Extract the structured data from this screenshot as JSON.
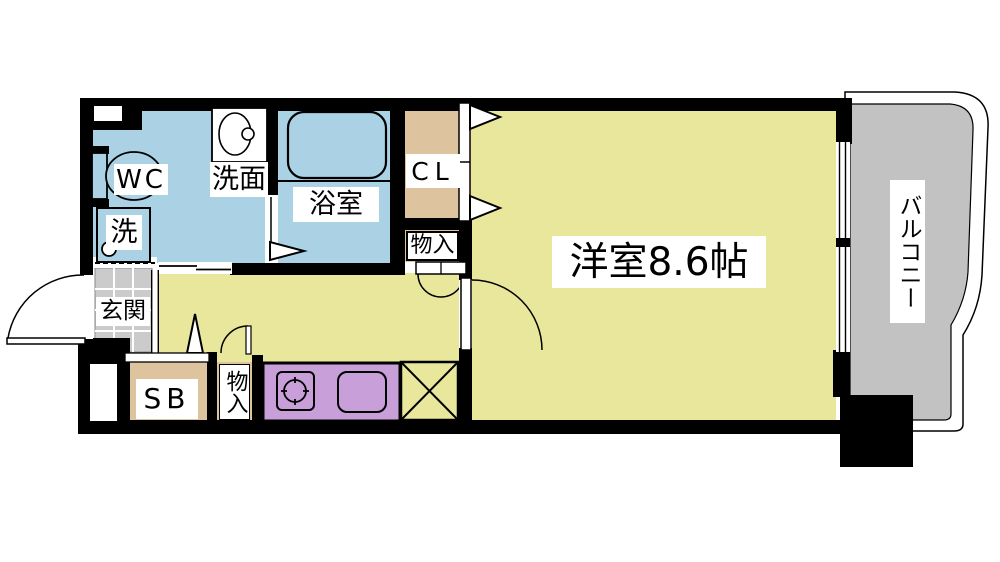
{
  "type": "floor_plan",
  "palette": {
    "wet_area_blue": "#aad2e4",
    "room_yellow": "#e9e79b",
    "closet_tan": "#dec49e",
    "kitchen_purple": "#c89fd9",
    "balcony_gray": "#c2c2c2",
    "entrance_tile_gray": "#cbcbcb",
    "wall_black": "#000000",
    "background": "#ffffff"
  },
  "rooms": {
    "wc": {
      "label": "WC"
    },
    "washer": {
      "label": "洗"
    },
    "washroom": {
      "label": "洗面"
    },
    "bathroom": {
      "label": "浴室"
    },
    "closet": {
      "label": "CL"
    },
    "storage_upper": {
      "label": "物入"
    },
    "western_room": {
      "label": "洋室8.6帖"
    },
    "entrance": {
      "label": "玄関"
    },
    "shoe_box": {
      "label": "SB"
    },
    "storage_lower": {
      "label": "物入"
    },
    "balcony": {
      "label": "バルコニー"
    }
  }
}
